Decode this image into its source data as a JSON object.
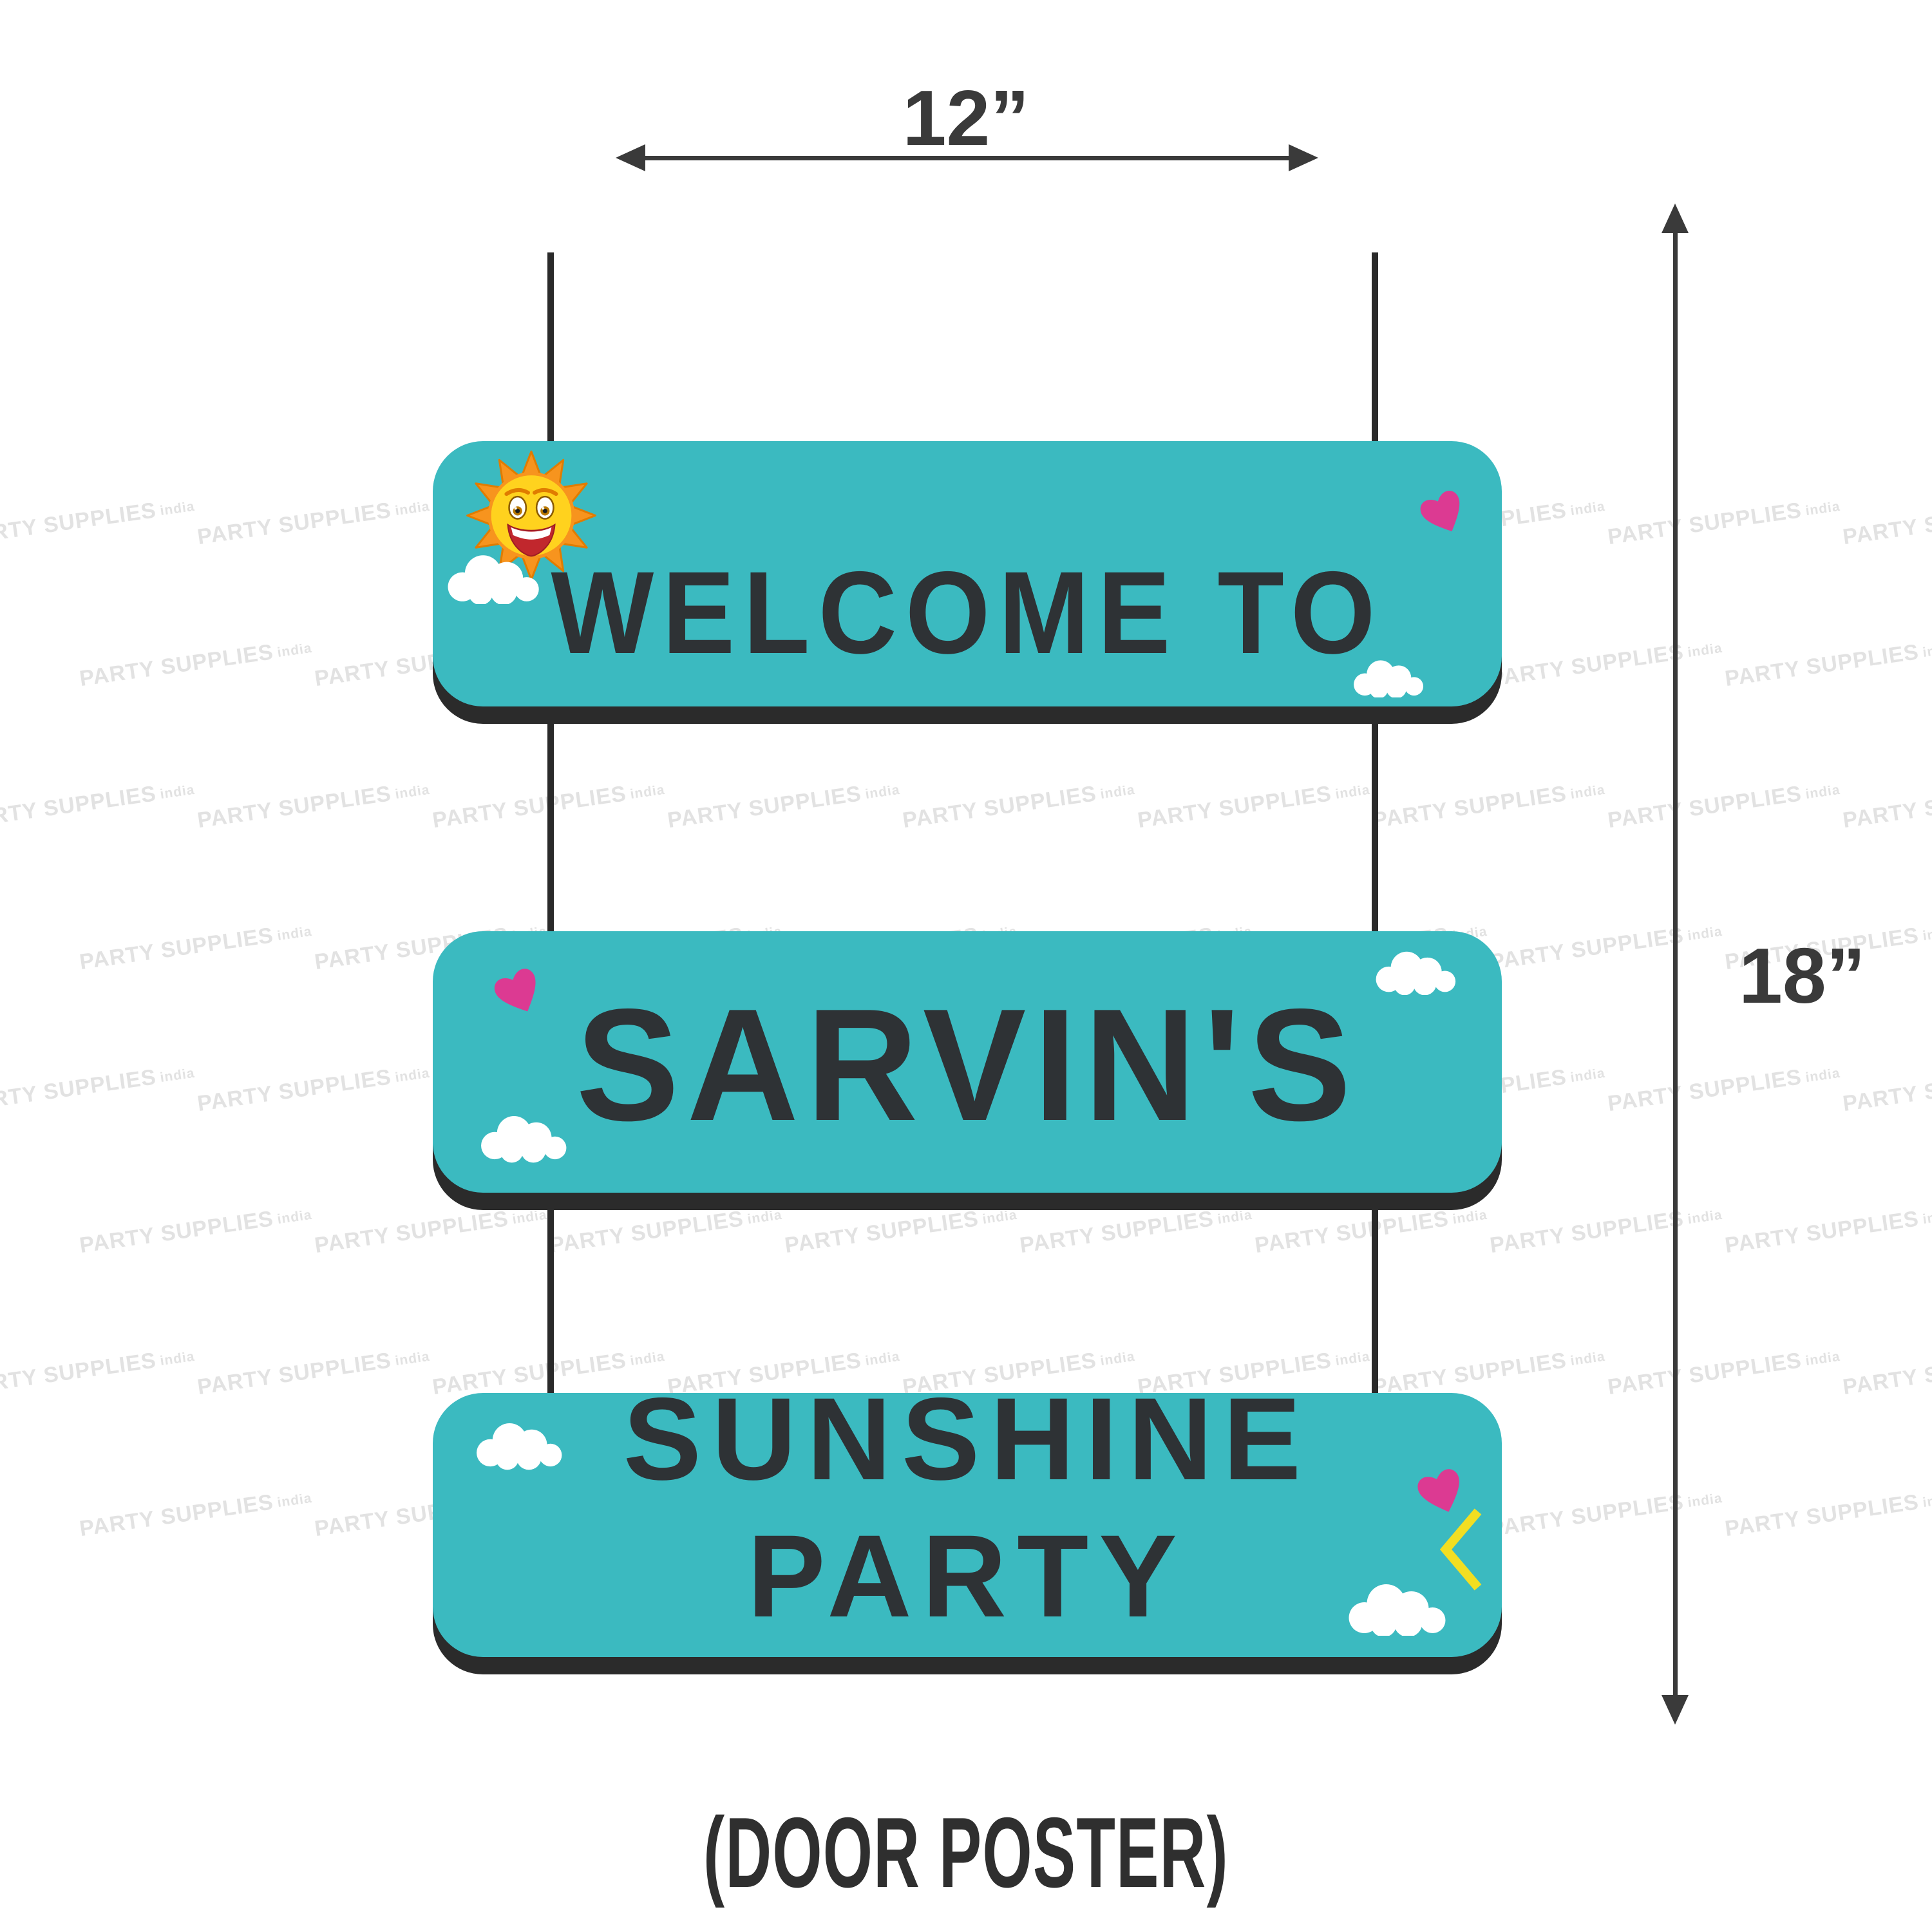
{
  "colors": {
    "teal": "#3BBAC0",
    "board_shadow": "#2B2B2B",
    "sign_text": "#2E3235",
    "string": "#2A2A2A",
    "dimension": "#3A3A3A",
    "heart_pink": "#DC3A92",
    "chevron_yellow": "#F2DE22",
    "cloud_white": "#FFFFFF",
    "watermark": "#E2E2E2",
    "sun_orange": "#F7941E",
    "sun_yellow": "#FFD21E"
  },
  "dimensions": {
    "width_label": "12”",
    "height_label": "18”"
  },
  "caption": "(DOOR POSTER)",
  "boards": [
    {
      "line1": "WELCOME TO",
      "line2": ""
    },
    {
      "line1": "SARVIN'S",
      "line2": ""
    },
    {
      "line1": "SUNSHINE",
      "line2": "PARTY"
    }
  ],
  "watermark": {
    "text": "PARTY SUPPLIES",
    "suffix": "india"
  },
  "icons": [
    "sun-icon",
    "cloud-icon",
    "heart-icon",
    "chevron-left-icon",
    "arrow-horizontal-icon",
    "arrow-vertical-icon"
  ]
}
